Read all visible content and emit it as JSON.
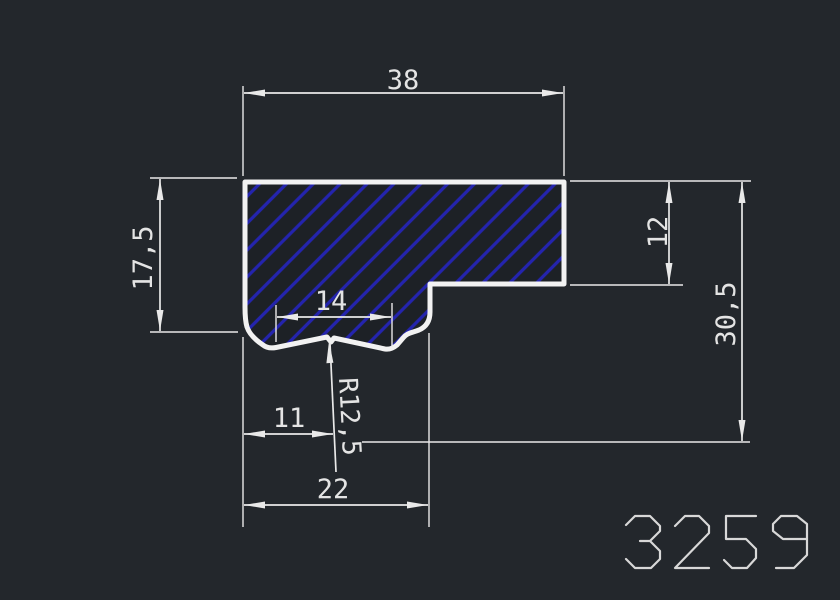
{
  "drawing": {
    "type": "cad-profile-section",
    "drawing_number": "3259",
    "dimensions": {
      "width_top": "38",
      "height_left": "17,5",
      "height_right_inner": "12",
      "height_right_total": "30,5",
      "notch_width": "14",
      "notch_center_offset": "11",
      "width_bottom_left": "22",
      "notch_radius": "R12,5"
    }
  },
  "colors": {
    "background": "#23272c",
    "background_inner": "#1d2126",
    "line": "#e9e9e9",
    "outline": "#f2f2f2",
    "hatch": "#2424ae",
    "text": "#e4e4e4",
    "number": "#d8d8d8"
  }
}
